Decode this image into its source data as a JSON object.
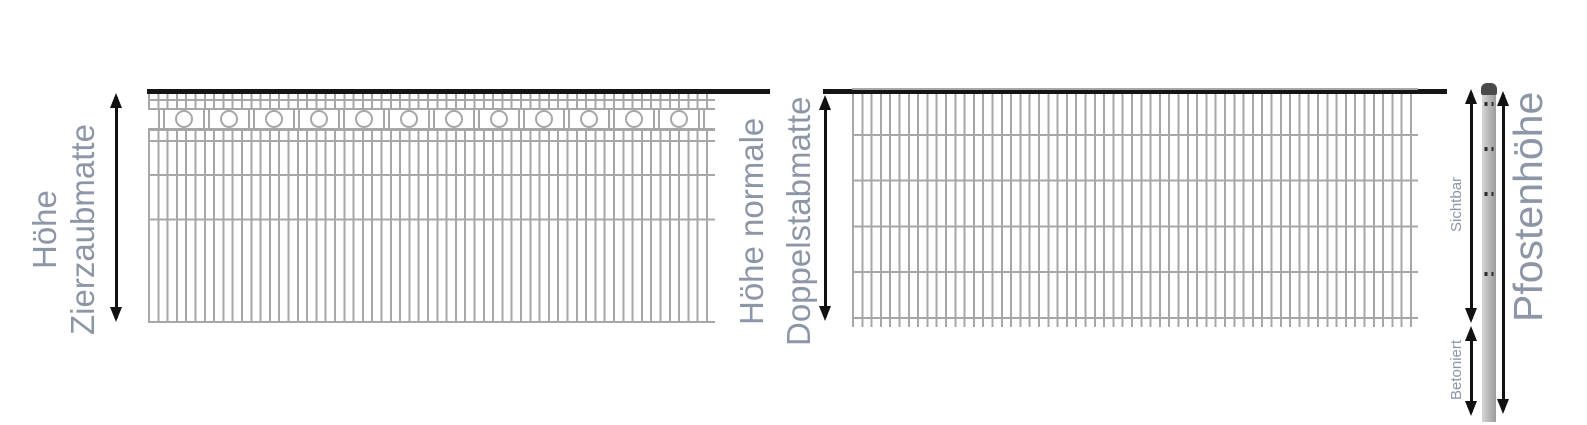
{
  "diagram": {
    "background": "#ffffff",
    "colors": {
      "label_text": "#8d96a7",
      "mesh_wire": "#a7a7a7",
      "top_rail": "#151515",
      "arrow": "#111111",
      "post_body": "#bababa",
      "post_cap": "#4a4a4a"
    }
  },
  "left_panel": {
    "label_line1": "Höhe",
    "label_line2": "Zierzaubmatte",
    "circle_count": 12
  },
  "right_panel": {
    "label_line1": "Höhe normale",
    "label_line2": "Doppelstabmatte"
  },
  "post": {
    "label": "Pfostenhöhe",
    "visible_label": "Sichtbar",
    "concreted_label": "Betoniert",
    "hole_pair_count": 4
  }
}
